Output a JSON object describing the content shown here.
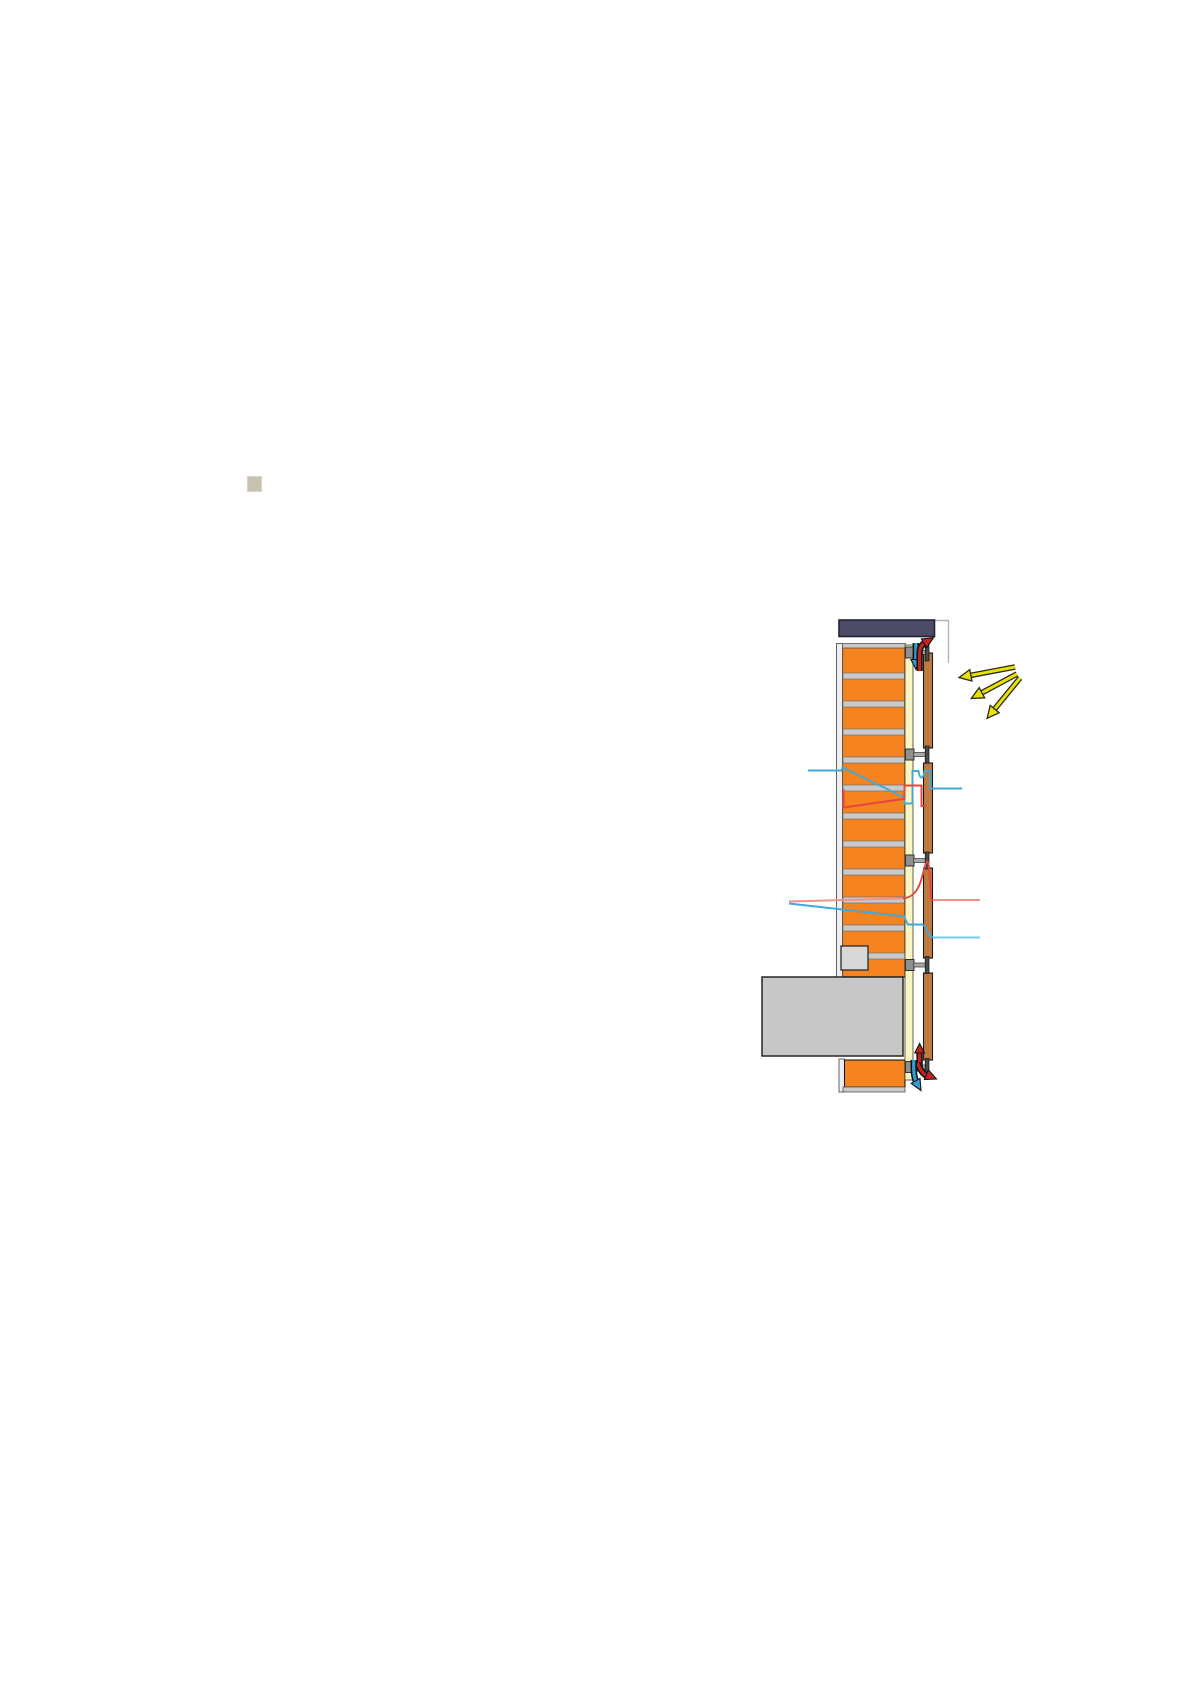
{
  "page": {
    "background": "#ffffff"
  },
  "bullet": {
    "color": "#c6c2ae"
  },
  "diagram": {
    "name": "ventilated-solar-facade-section",
    "colors": {
      "coping": "#4c4c66",
      "coping_border": "#23233a",
      "brick": "#f5831f",
      "outline": "#1a1a1a",
      "mortar": "#cacaca",
      "mortar_edge": "#787878",
      "wall_edge": "#efefef",
      "wall_edge_line": "#555555",
      "insulation": "#fbf5c3",
      "insulation_edge": "#3a3a2e",
      "glazing": "#bd7b42",
      "bracket": "#8f8f8f",
      "bracket_rod": "#a8a8a8",
      "bracket_tbar": "#4a4a4a",
      "slab": "#c7c7c7",
      "lintel": "#d8d8d8",
      "warm": "#e8443e",
      "warm_light": "#f59089",
      "cool": "#3fa9dc",
      "cool_light": "#74c9ef",
      "sun": "#e9e104",
      "sun_outline": "#2a2a1a",
      "arrow_red": "#c42420",
      "arrow_blue": "#2e9fd4",
      "arrow_outline": "#141414",
      "ref_line": "#b5b5b5"
    },
    "mortar_bands": [
      [
        843,
        673,
        61.5
      ],
      [
        843,
        701,
        61.5
      ],
      [
        843,
        729,
        61.5
      ],
      [
        843,
        757,
        61.5
      ],
      [
        843,
        785,
        61.5
      ],
      [
        843,
        813,
        61.5
      ],
      [
        843,
        841,
        61.5
      ],
      [
        843,
        869,
        61.5
      ],
      [
        843,
        897,
        61.5
      ],
      [
        843,
        925,
        61.5
      ],
      [
        868,
        953,
        37
      ]
    ],
    "glazing_segments": [
      [
        653,
        748
      ],
      [
        763,
        853
      ],
      [
        868,
        958
      ],
      [
        973,
        1060
      ]
    ],
    "bracket_centers": [
      652.5,
      754.5,
      860.5,
      965,
      1067
    ],
    "sun_rays": [
      {
        "x1": 1015,
        "y1": 667,
        "x2": 962,
        "y2": 677
      },
      {
        "x1": 1017,
        "y1": 674,
        "x2": 974,
        "y2": 697
      },
      {
        "x1": 1020,
        "y1": 678,
        "x2": 989,
        "y2": 716
      }
    ]
  }
}
